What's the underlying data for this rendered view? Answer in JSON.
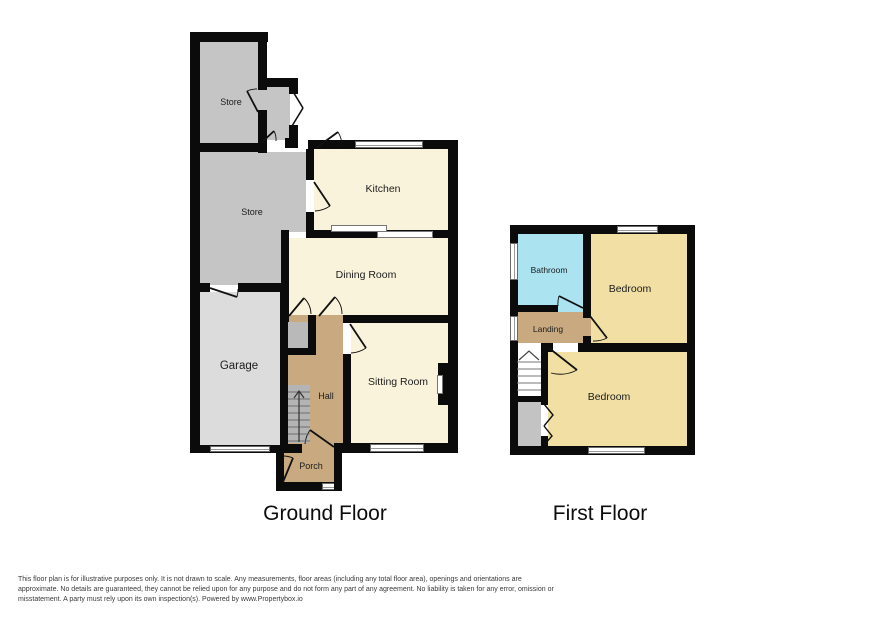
{
  "ground_floor": {
    "title": "Ground Floor",
    "rooms": [
      {
        "id": "store-1",
        "label": "Store"
      },
      {
        "id": "store-2",
        "label": "Store"
      },
      {
        "id": "garage",
        "label": "Garage"
      },
      {
        "id": "kitchen",
        "label": "Kitchen"
      },
      {
        "id": "dining-room",
        "label": "Dining Room"
      },
      {
        "id": "sitting-room",
        "label": "Sitting Room"
      },
      {
        "id": "hall",
        "label": "Hall"
      },
      {
        "id": "porch",
        "label": "Porch"
      }
    ]
  },
  "first_floor": {
    "title": "First Floor",
    "rooms": [
      {
        "id": "bathroom",
        "label": "Bathroom"
      },
      {
        "id": "bedroom-1",
        "label": "Bedroom"
      },
      {
        "id": "landing",
        "label": "Landing"
      },
      {
        "id": "bedroom-2",
        "label": "Bedroom"
      }
    ]
  },
  "disclaimer": {
    "lines": [
      "This floor plan is for illustrative purposes only. It is not drawn to scale. Any measurements, floor areas (including any total floor area), openings and orientations are",
      "approximate. No details are guaranteed, they cannot be relied upon for any purpose and do not form any part of any agreement. No liability is taken for any error, omission or",
      "misstatement. A party must rely upon its own inspection(s). Powered by www.Propertybox.io"
    ]
  },
  "colors": {
    "wall": "#0b0b0b",
    "room_cream": "#faf3dc",
    "room_tan": "#c9aa80",
    "room_store": "#c5c5c5",
    "room_garage": "#dcdcdc",
    "room_bedroom": "#f1dfa4",
    "room_bathroom": "#abe3f1",
    "stairs_gray": "#b4b4b4",
    "understairs_gray": "#c3c3c3",
    "cupboard_gray": "#b9b9b9"
  }
}
